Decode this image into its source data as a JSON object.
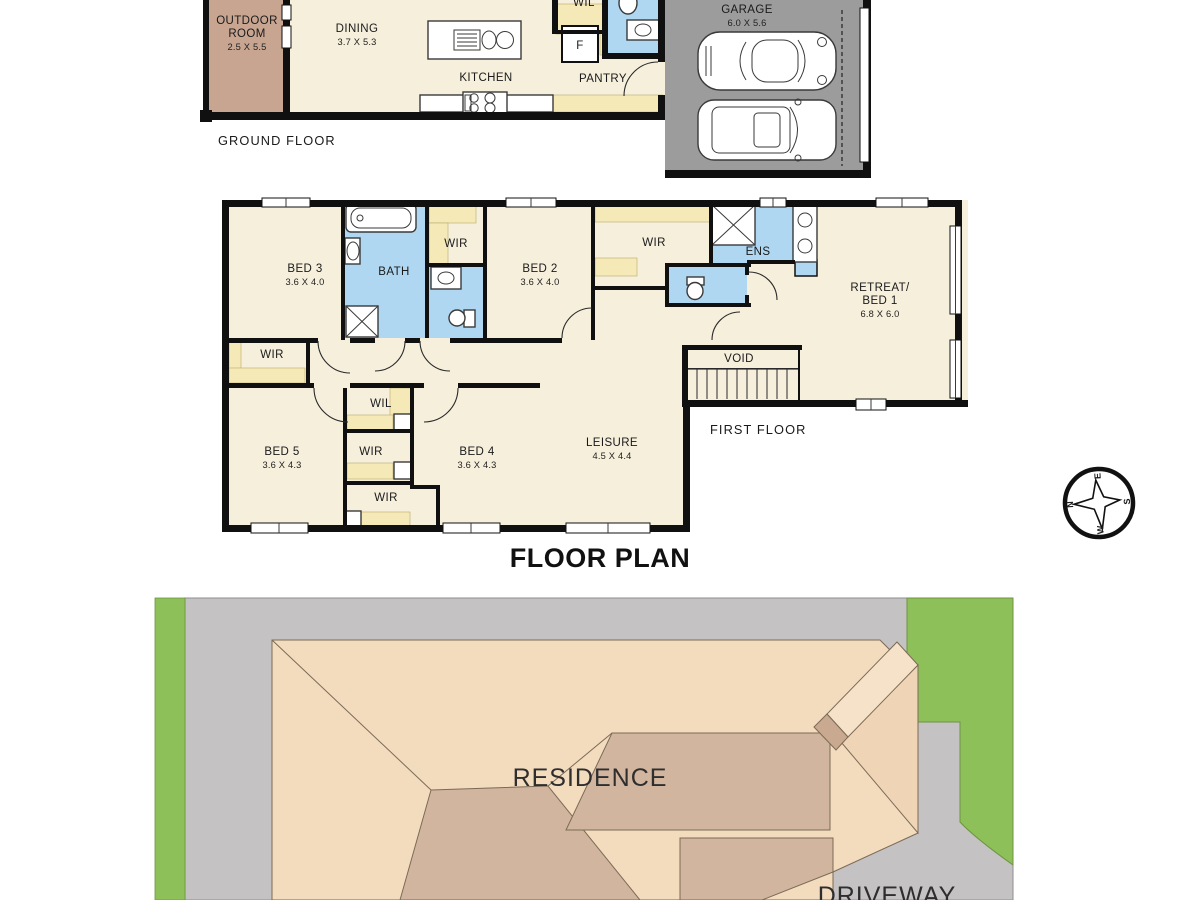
{
  "title": "FLOOR PLAN",
  "colors": {
    "floor_cream": "#F5EFDC",
    "robe_yellow": "#F6E9B8",
    "wet_blue": "#AFD7F2",
    "wall_black": "#101010",
    "garage_gray": "#9C9C9C",
    "outdoor_brown": "#C8A591",
    "site_gray": "#C4C2C2",
    "grass_green": "#8EC05A",
    "roof_light": "#F3DBBE",
    "roof_dark": "#D2B59E"
  },
  "ground_floor": {
    "label": "GROUND FLOOR",
    "outdoor_room": {
      "line1": "OUTDOOR",
      "line2": "ROOM",
      "dims": "2.5 X 5.5"
    },
    "dining": {
      "name": "DINING",
      "dims": "3.7 X 5.3"
    },
    "kitchen": {
      "name": "KITCHEN"
    },
    "pantry": {
      "name": "PANTRY"
    },
    "fridge": "F",
    "wil": "WIL",
    "garage": {
      "name": "GARAGE",
      "dims": "6.0 X 5.6"
    }
  },
  "first_floor": {
    "label": "FIRST FLOOR",
    "bed3": {
      "name": "BED 3",
      "dims": "3.6 X 4.0"
    },
    "bath": "BATH",
    "wir_top": "WIR",
    "bed2": {
      "name": "BED 2",
      "dims": "3.6 X 4.0"
    },
    "wir_mid_top": "WIR",
    "ens": "ENS",
    "retreat": {
      "line1": "RETREAT/",
      "line2": "BED 1",
      "dims": "6.8 X 6.0"
    },
    "void": "VOID",
    "wir_left": "WIR",
    "bed5": {
      "name": "BED 5",
      "dims": "3.6 X 4.3"
    },
    "wil": "WIL",
    "wir_center": "WIR",
    "wir_lower": "WIR",
    "bed4": {
      "name": "BED 4",
      "dims": "3.6 X 4.3"
    },
    "leisure": {
      "name": "LEISURE",
      "dims": "4.5 X 4.4"
    }
  },
  "site_plan": {
    "residence": "RESIDENCE",
    "driveway": "DRIVEWAY"
  },
  "compass": {
    "n": "N",
    "e": "E",
    "s": "S",
    "w": "W"
  }
}
